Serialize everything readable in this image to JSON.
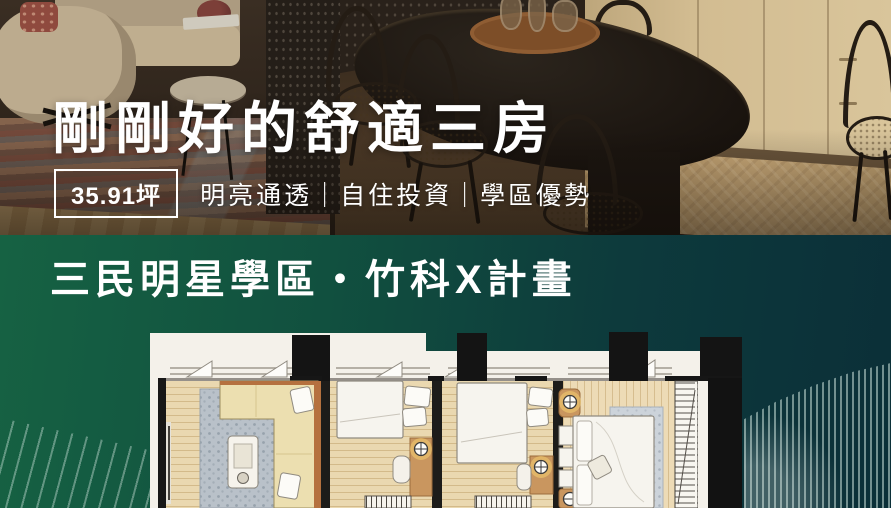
{
  "hero": {
    "title": "剛剛好的舒適三房",
    "area_badge": "35.91坪",
    "tagline": "明亮通透｜自住投資｜學區優勢"
  },
  "location_section": {
    "title": "三民明星學區・竹科X計畫"
  },
  "colors": {
    "green_left": "#166243",
    "green_right": "#0B2F38",
    "text_white": "#FFFFFF"
  }
}
